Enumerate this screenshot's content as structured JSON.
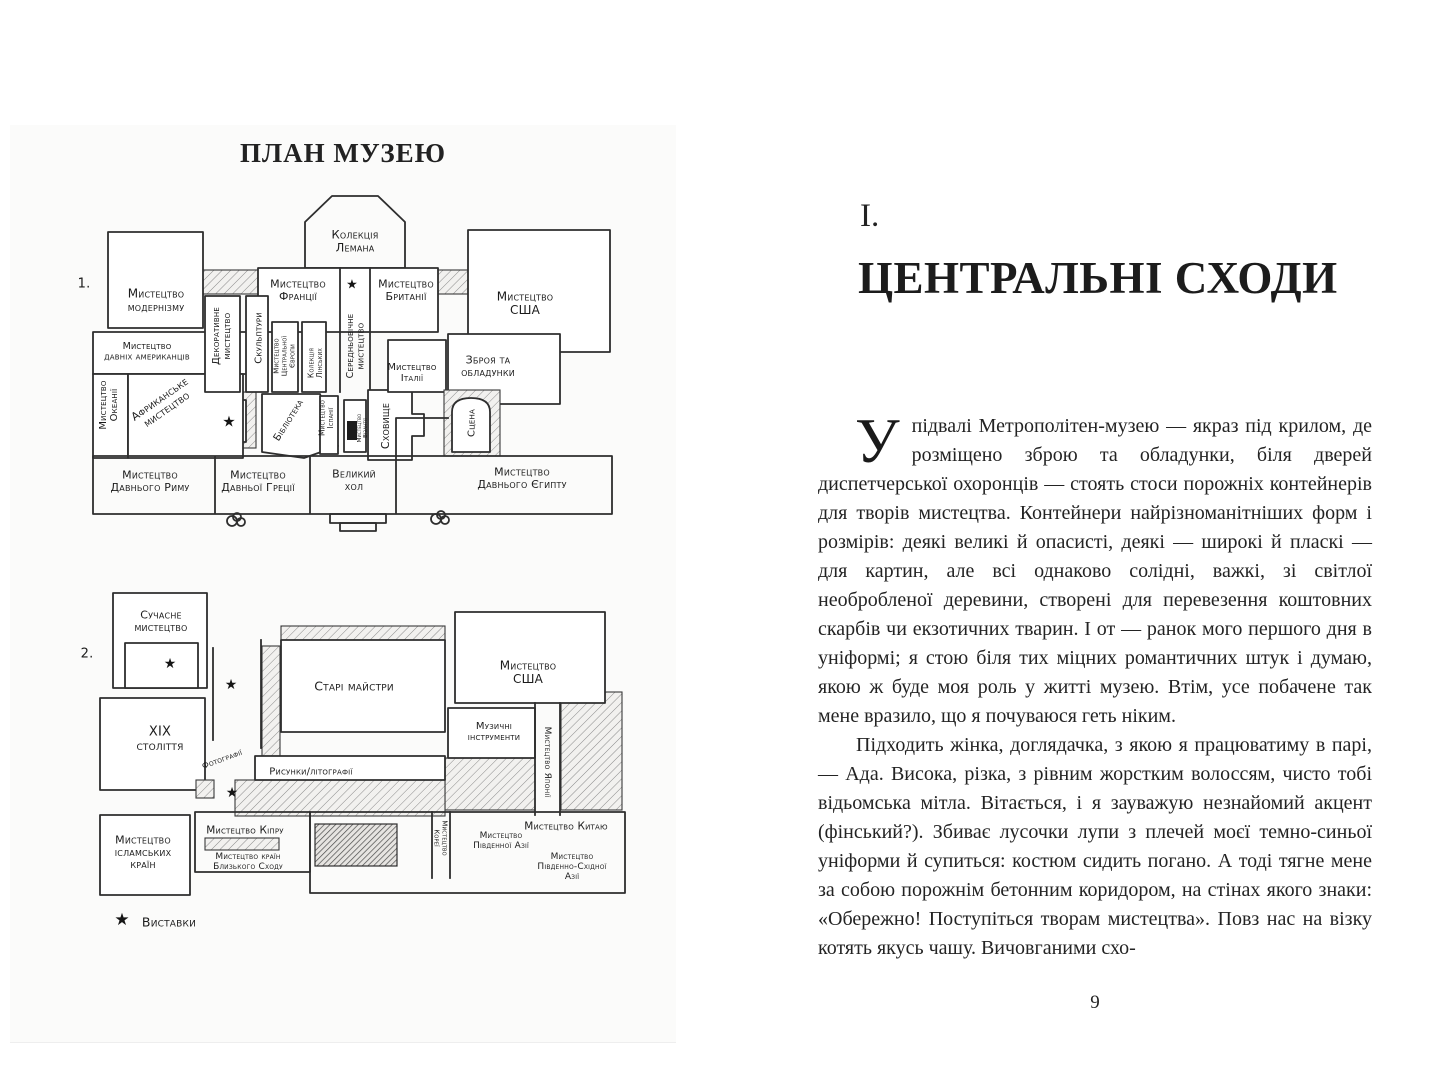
{
  "page_left": {
    "title": "ПЛАН МУЗЕЮ",
    "star_glyph": "★",
    "floors": [
      {
        "id": "1",
        "labels": [
          {
            "x": 84,
            "y": 283,
            "s": 13,
            "cls": "num",
            "lines": [
              "1."
            ]
          },
          {
            "x": 156,
            "y": 300,
            "s": 12,
            "lines": [
              "Мистецтво",
              "модернізму"
            ]
          },
          {
            "x": 355,
            "y": 241,
            "s": 11.5,
            "lines": [
              "Колекція",
              "Лемана"
            ]
          },
          {
            "x": 298,
            "y": 290,
            "s": 11,
            "lines": [
              "Мистецтво",
              "Франції"
            ]
          },
          {
            "x": 406,
            "y": 290,
            "s": 11,
            "lines": [
              "Мистецтво",
              "Британії"
            ]
          },
          {
            "x": 525,
            "y": 303,
            "s": 12,
            "lines": [
              "Мистецтво",
              "США"
            ]
          },
          {
            "x": 147,
            "y": 351,
            "s": 9.5,
            "lines": [
              "Мистецтво",
              "давніх американців"
            ]
          },
          {
            "x": 108,
            "y": 405,
            "s": 10,
            "rot": -90,
            "lines": [
              "Мистецтво",
              "Океанії"
            ]
          },
          {
            "x": 163,
            "y": 404,
            "s": 11,
            "rot": -35,
            "lines": [
              "Африканське",
              "мистецтво"
            ]
          },
          {
            "x": 221,
            "y": 336,
            "s": 10,
            "rot": -90,
            "lines": [
              "Декоративне",
              "мистецтво"
            ]
          },
          {
            "x": 258,
            "y": 338,
            "s": 10,
            "rot": -90,
            "lines": [
              "Скульптури"
            ]
          },
          {
            "x": 284,
            "y": 356,
            "s": 7,
            "rot": -90,
            "lines": [
              "Мистецтво",
              "Центральної",
              "Європи"
            ]
          },
          {
            "x": 315,
            "y": 363,
            "s": 7.5,
            "rot": -90,
            "lines": [
              "Колекція",
              "Лінських"
            ]
          },
          {
            "x": 355,
            "y": 346,
            "s": 9.5,
            "rot": -90,
            "lines": [
              "Середньовічне",
              "мистецтво"
            ]
          },
          {
            "x": 288,
            "y": 420,
            "s": 10,
            "rot": -58,
            "lines": [
              "Бібліотека"
            ]
          },
          {
            "x": 326,
            "y": 418,
            "s": 7.5,
            "rot": -90,
            "lines": [
              "Мистецтво",
              "Іспанії"
            ]
          },
          {
            "x": 362,
            "y": 428,
            "s": 5.5,
            "rot": -90,
            "lines": [
              "Мистецтво",
              "Візантії"
            ]
          },
          {
            "x": 385,
            "y": 426,
            "s": 11,
            "rot": -90,
            "lines": [
              "Сховище"
            ]
          },
          {
            "x": 412,
            "y": 372,
            "s": 10,
            "lines": [
              "Мистецтво",
              "Італії"
            ]
          },
          {
            "x": 488,
            "y": 366,
            "s": 11,
            "lines": [
              "Зброя та",
              "обладунки"
            ]
          },
          {
            "x": 471,
            "y": 423,
            "s": 10,
            "rot": -90,
            "lines": [
              "Сцена"
            ]
          },
          {
            "x": 354,
            "y": 480,
            "s": 11,
            "lines": [
              "Великий",
              "хол"
            ]
          },
          {
            "x": 150,
            "y": 481,
            "s": 11,
            "lines": [
              "Мистецтво",
              "Давнього Риму"
            ]
          },
          {
            "x": 258,
            "y": 481,
            "s": 11,
            "lines": [
              "Мистецтво",
              "Давньої Греції"
            ]
          },
          {
            "x": 522,
            "y": 478,
            "s": 11,
            "lines": [
              "Мистецтво",
              "Давнього Єгипту"
            ]
          }
        ],
        "stars": [
          [
            352,
            284,
            13
          ],
          [
            229,
            421,
            15
          ]
        ]
      },
      {
        "id": "2",
        "labels": [
          {
            "x": 87,
            "y": 653,
            "s": 13,
            "cls": "num",
            "lines": [
              "2."
            ]
          },
          {
            "x": 161,
            "y": 621,
            "s": 11,
            "lines": [
              "Сучасне",
              "мистецтво"
            ]
          },
          {
            "x": 354,
            "y": 686,
            "s": 12.5,
            "lines": [
              "Старі майстри"
            ]
          },
          {
            "x": 528,
            "y": 672,
            "s": 12,
            "lines": [
              "Мистецтво",
              "США"
            ]
          },
          {
            "x": 160,
            "y": 738,
            "s": 13,
            "lines": [
              "XIX",
              "століття"
            ]
          },
          {
            "x": 494,
            "y": 731,
            "s": 10,
            "lines": [
              "Музичні",
              "інструменти"
            ]
          },
          {
            "x": 548,
            "y": 762,
            "s": 9,
            "rot": 90,
            "lines": [
              "Мистецтво Японії"
            ]
          },
          {
            "x": 222,
            "y": 759,
            "s": 8,
            "rot": -20,
            "lines": [
              "Фотографії"
            ]
          },
          {
            "x": 311,
            "y": 771,
            "s": 10,
            "lines": [
              "Рисунки/літографії"
            ]
          },
          {
            "x": 245,
            "y": 830,
            "s": 10.5,
            "lines": [
              "Мистецтво Кіпру"
            ]
          },
          {
            "x": 143,
            "y": 852,
            "s": 11,
            "lines": [
              "Мистецтво",
              "ісламських",
              "країн"
            ]
          },
          {
            "x": 248,
            "y": 861,
            "s": 9,
            "lines": [
              "Мистецтво країн",
              "Близького Сходу"
            ]
          },
          {
            "x": 441,
            "y": 838,
            "s": 7,
            "rot": 90,
            "lines": [
              "Мистецтво",
              "Кореї"
            ]
          },
          {
            "x": 501,
            "y": 840,
            "s": 9,
            "lines": [
              "Мистецтво",
              "Південної Азії"
            ]
          },
          {
            "x": 566,
            "y": 826,
            "s": 10.5,
            "lines": [
              "Мистецтво Китаю"
            ]
          },
          {
            "x": 572,
            "y": 866,
            "s": 9,
            "lines": [
              "Мистецтво",
              "Південно-Східної",
              "Азії"
            ]
          },
          {
            "x": 169,
            "y": 922,
            "s": 12.5,
            "cls": "legend",
            "lines": [
              "Виставки"
            ]
          }
        ],
        "stars": [
          [
            170,
            663,
            14
          ],
          [
            231,
            684,
            14
          ],
          [
            232,
            792,
            14
          ],
          [
            122,
            919,
            17
          ]
        ]
      }
    ]
  },
  "page_right": {
    "chapter_number": "I.",
    "chapter_title": "ЦЕНТРАЛЬНІ СХОДИ",
    "dropcap": "У",
    "paragraphs": [
      "підвалі Метрополітен-музею — якраз під крилом, де розміщено зброю та обладунки, біля дверей диспетчерської охоронців — стоять стоси порожніх контейнерів для творів мистецтва. Контейнери найрізноманітніших форм і розмірів: деякі великі й опасисті, деякі — широкі й пласкі — для картин, але всі однаково солідні, важкі, зі світлої необробленої деревини, створені для перевезення коштовних скарбів чи екзотичних тварин. І от — ранок мого першого дня в уніформі; я стою біля тих міцних романтичних штук і думаю, якою ж буде моя роль у житті музею. Втім, усе побачене так мене вразило, що я почуваюся геть ніким.",
      "Підходить жінка, доглядачка, з якою я працюватиму в парі, — Ада. Висока, різка, з рівним жорстким волоссям, чисто тобі відьомська мітла. Вітається, і я зауважую незнайомий акцент (фінський?). Збиває лусочки лупи з плечей моєї темно-синьої уніформи й супиться: костюм сидить погано. А тоді тягне мене за собою порожнім бетонним коридором, на стінах якого знаки: «Обережно! Поступіться творам мистецтва». Повз нас на візку котять якусь чашу. Вичовганими схо-"
    ],
    "page_number": "9"
  }
}
